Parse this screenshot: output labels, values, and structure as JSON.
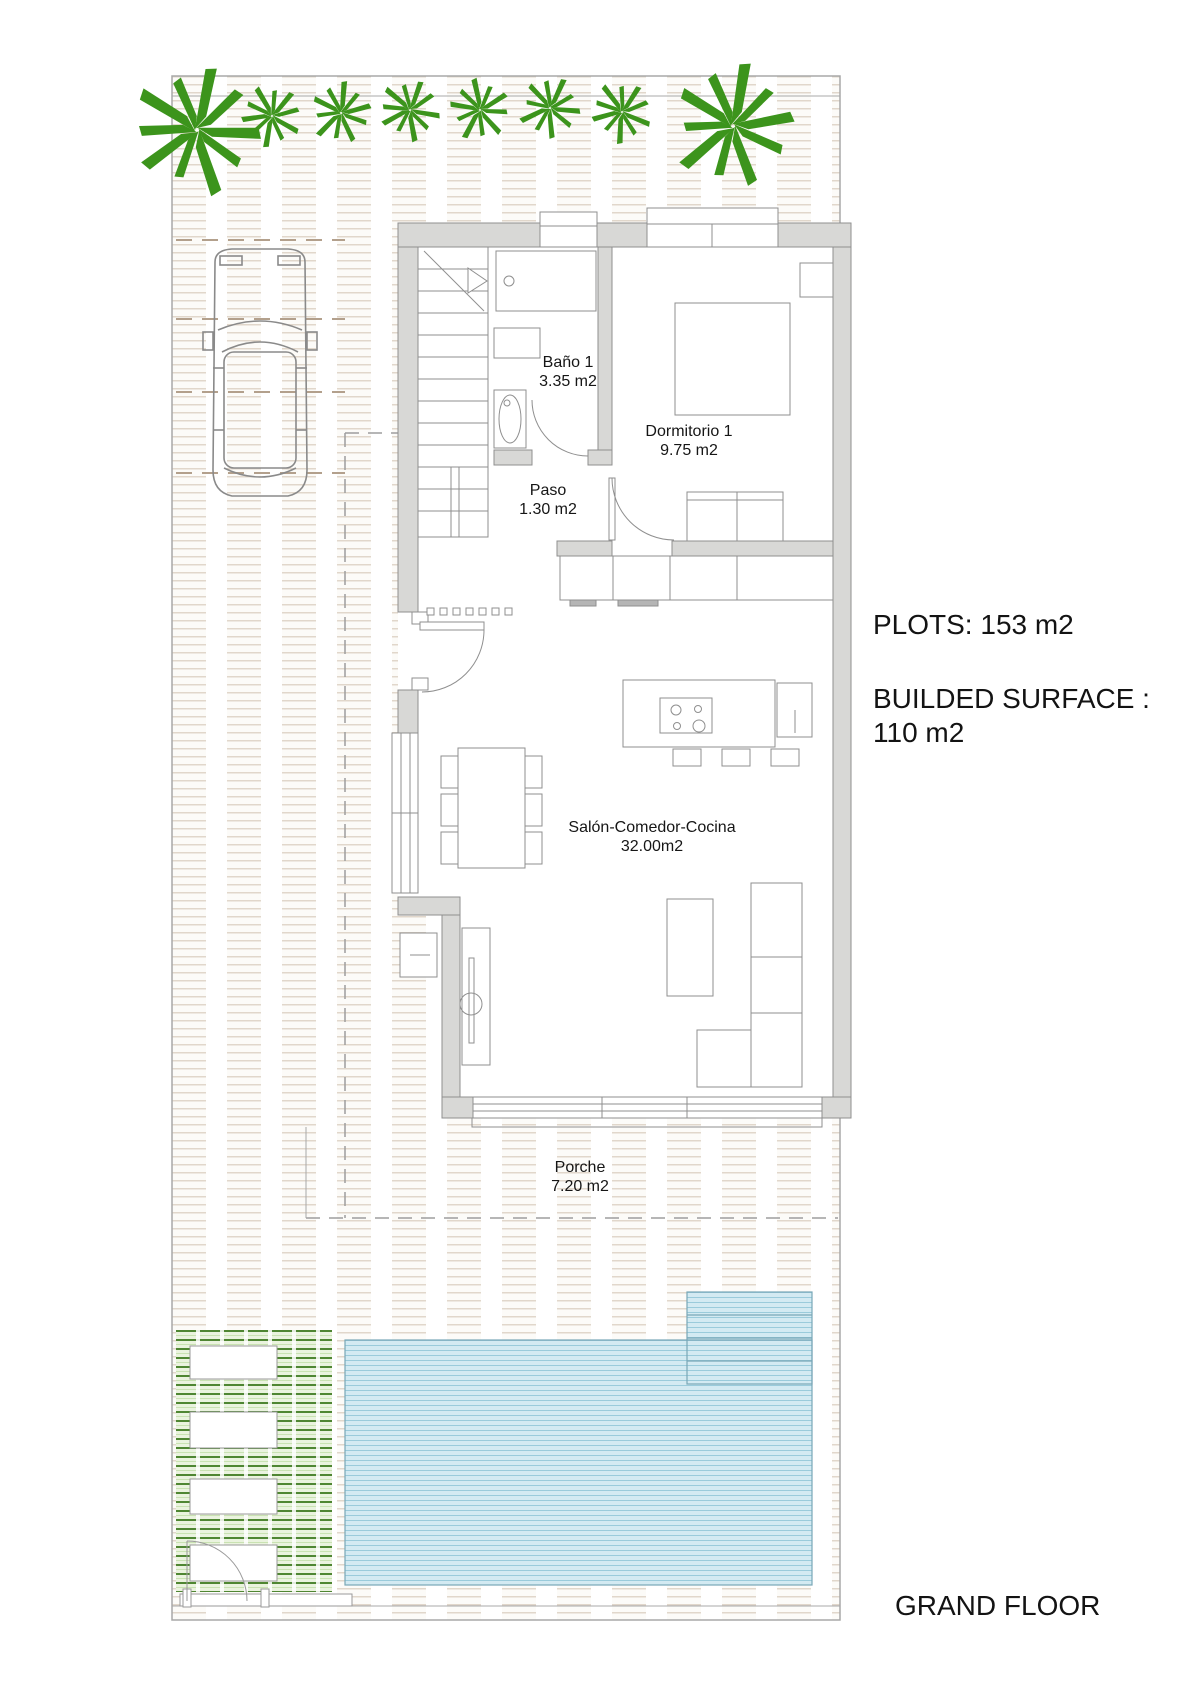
{
  "plan": {
    "watermark": "- ESTATE SPAIN -",
    "floor_label": "GRAND FLOOR",
    "annotations": {
      "plots": "PLOTS: 153 m2",
      "builded_line1": "BUILDED SURFACE :",
      "builded_line2": "110 m2"
    },
    "rooms": [
      {
        "id": "bano",
        "name": "Baño 1",
        "area": "3.35 m2"
      },
      {
        "id": "dormitorio",
        "name": "Dormitorio 1",
        "area": "9.75 m2"
      },
      {
        "id": "paso",
        "name": "Paso",
        "area": "1.30 m2"
      },
      {
        "id": "salon",
        "name": "Salón-Comedor-Cocina",
        "area": "32.00m2"
      },
      {
        "id": "porche",
        "name": "Porche",
        "area": "7.20 m2"
      }
    ],
    "colors": {
      "palm_green": "#3c941c",
      "lawn_green": "#c9e2b2",
      "pool_blue": "#d3eaf2",
      "wall_gray": "#d8d8d6",
      "paving_beige": "#cbb9a6"
    },
    "features": {
      "palm_trees": 8,
      "sunbeds": 4,
      "parking_spaces": 1,
      "swimming_pool": true
    }
  }
}
